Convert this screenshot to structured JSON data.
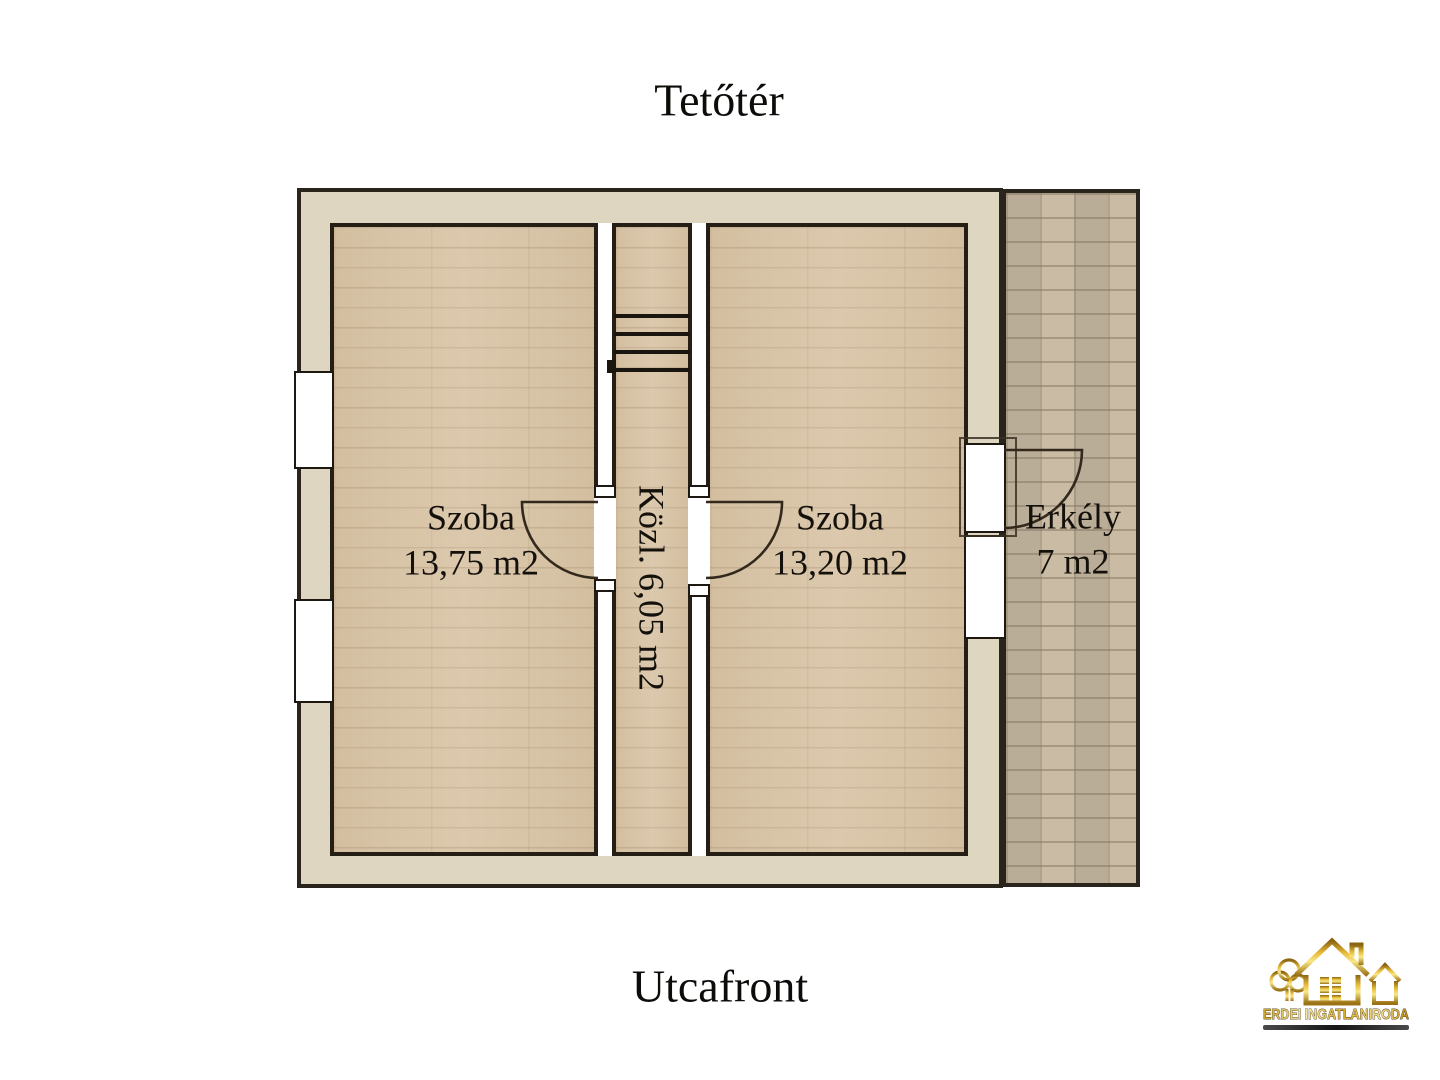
{
  "page": {
    "title": "Tetőtér",
    "bottom_label": "Utcafront"
  },
  "rooms": [
    {
      "name": "Szoba",
      "area": "13,75 m2"
    },
    {
      "name": "Szoba",
      "area": "13,20 m2"
    }
  ],
  "corridor": {
    "label": "Közl. 6,05 m2"
  },
  "balcony": {
    "name": "Erkély",
    "area": "7 m2"
  },
  "logo": {
    "text": "ERDEI INGATLANIRODA"
  },
  "colors": {
    "wall_fill": "#ded6c1",
    "wood_floor": "#d9c5a7",
    "balcony_tile": "#c7b89f",
    "line": "#241e15",
    "logo_gold": "#d9a928"
  }
}
